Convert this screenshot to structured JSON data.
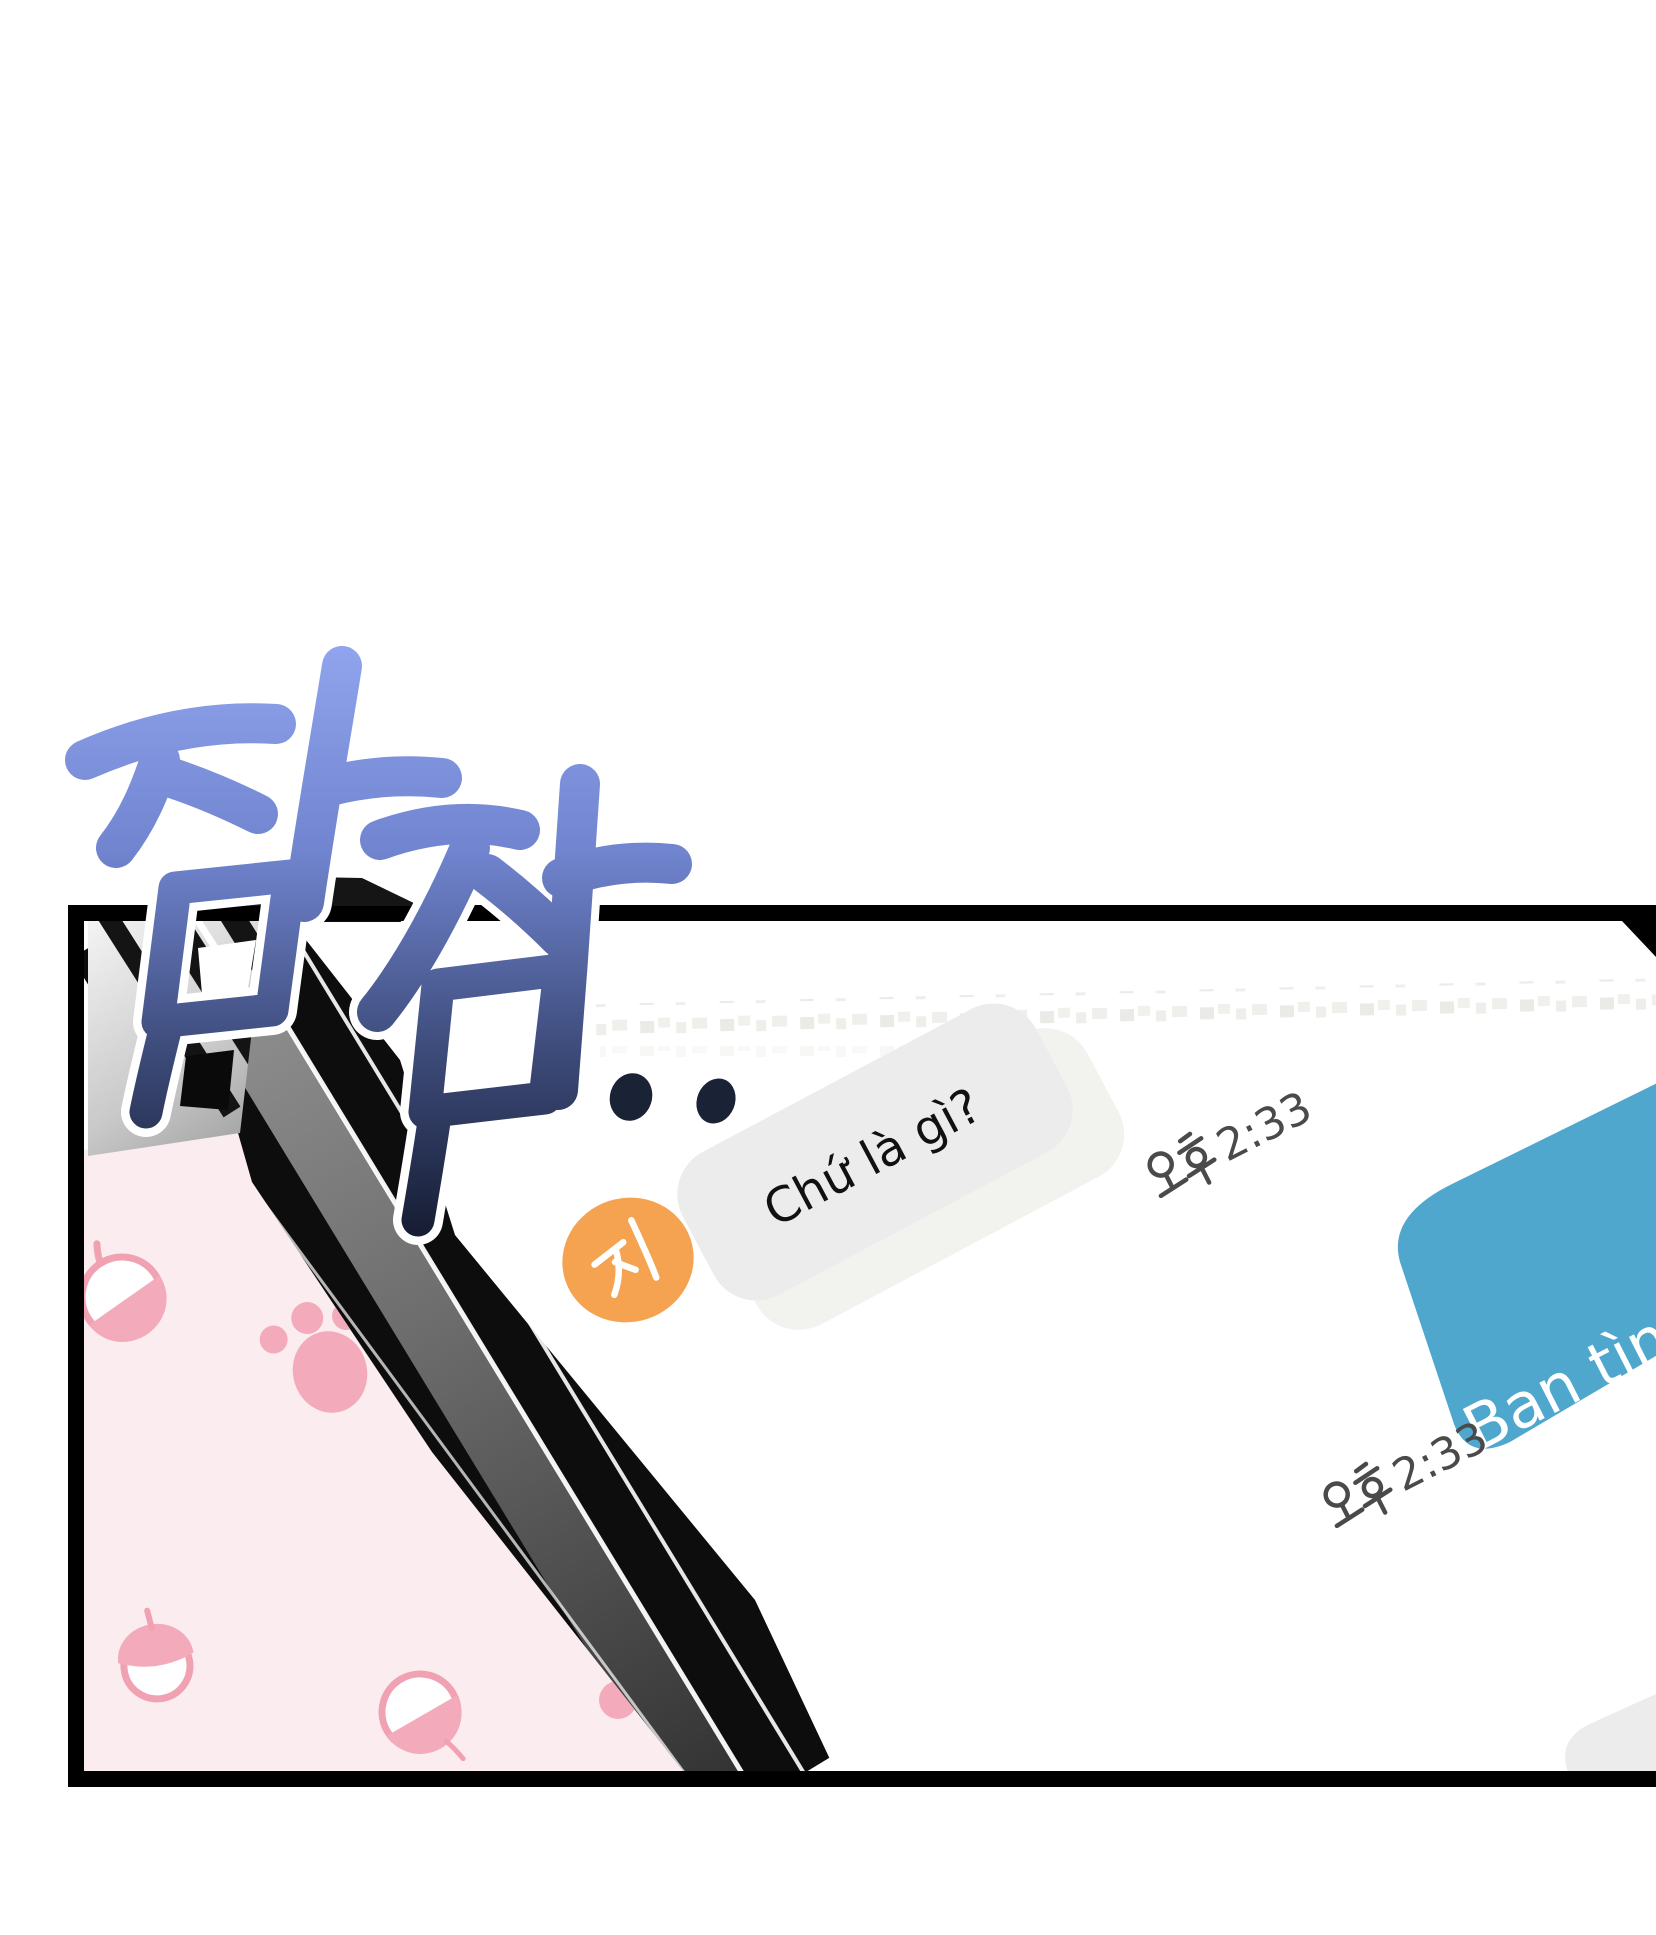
{
  "page": {
    "background": "#FFFFFF"
  },
  "sfx": {
    "text": "잠잠",
    "dots": "..",
    "gradient_top": "#90A3ED",
    "gradient_bottom": "#171E35"
  },
  "panel": {
    "border_color": "#000000"
  },
  "phone": {
    "case_pink": "#FBEDEF",
    "pattern_pink": "#F2A6B6",
    "edge_black": "#0D0D0D",
    "edge_gray_light": "#8F8F8F",
    "edge_gray_dark": "#333333",
    "screen_white": "#FFFFFF"
  },
  "chat": {
    "blurred_row_color": "#D9D9D1",
    "timestamp_color": "#4A4A4A",
    "incoming": {
      "avatar_initial": "지",
      "avatar_color": "#F5A350",
      "bubble_color": "#ECECEC",
      "text": "Chứ là gì?",
      "text_color": "#111111",
      "timestamp": "오후 2:33",
      "timestamp_digits": "2:33"
    },
    "outgoing": {
      "bubble_color": "#4FA7CE",
      "text": "Bạn tình",
      "text_color": "#FFFFFF",
      "timestamp": "오후 2:33",
      "timestamp_digits": "2:33"
    }
  }
}
